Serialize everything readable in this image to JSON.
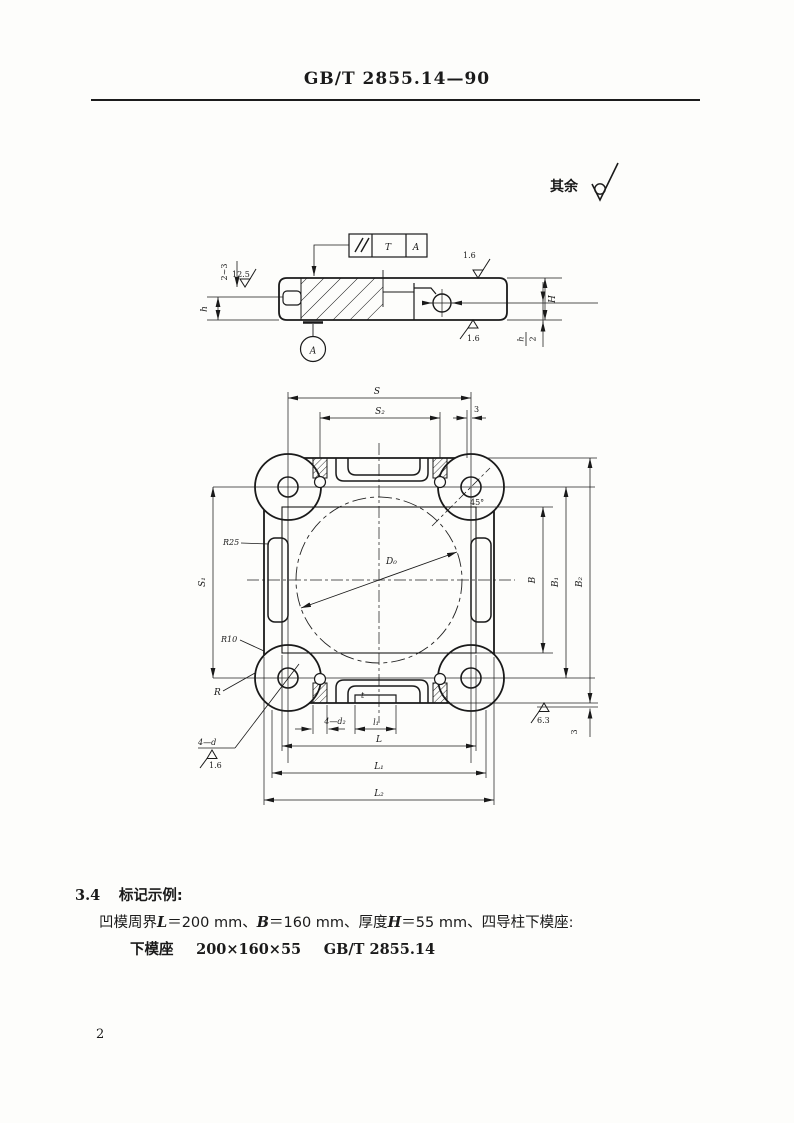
{
  "page": {
    "header": "GB/T 2855.14—90",
    "page_number": "2"
  },
  "surface_note": {
    "prefix": "其余"
  },
  "section_view": {
    "fcf": {
      "tolerance": "T",
      "datum": "A"
    },
    "labels": {
      "lip_range": "2~3",
      "rough_lip": "12.5",
      "h": "h",
      "rough_top": "1.6",
      "rough_bottom": "1.6",
      "H": "H",
      "h_half_num": "h",
      "h_half_den": "2",
      "datum_ref": "A"
    }
  },
  "plan_view": {
    "dims": {
      "S": "S",
      "S2": "S₂",
      "three_top": "3",
      "S1": "S₁",
      "B": "B",
      "B1": "B₁",
      "B2": "B₂",
      "L": "L",
      "L1": "L₁",
      "L2": "L₂",
      "l1": "l₁",
      "four_d2": "4—d₂",
      "t": "t",
      "four_d": "4—d",
      "R": "R",
      "R25": "R25",
      "R10": "R10",
      "D0": "D₀",
      "angle45": "45°",
      "rough_4d": "1.6",
      "rough_bottom": "6.3",
      "three_right": "3"
    }
  },
  "marking": {
    "section_no": "3.4",
    "section_title": "标记示例:",
    "spec_parts": [
      "凹模周界",
      "L",
      "＝200 mm、",
      "B",
      "＝160 mm、厚度",
      "H",
      "＝55 mm、四导柱下模座:"
    ],
    "designation_parts": [
      "下模座",
      "200×160×55",
      "GB/T 2855.14"
    ]
  }
}
